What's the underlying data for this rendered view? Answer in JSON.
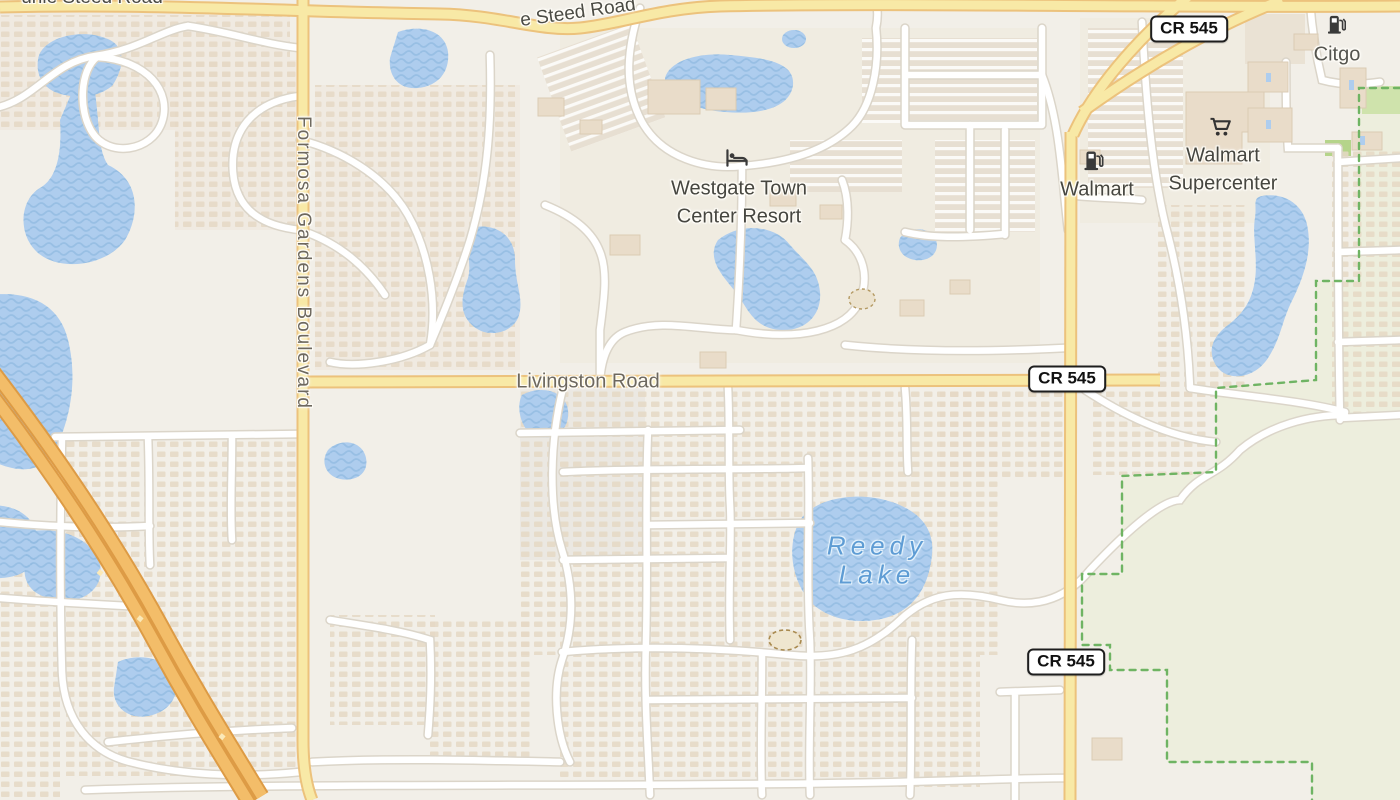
{
  "map": {
    "kind": "street-map",
    "road_labels": {
      "funie_steed_road_left": "unie Steed Road",
      "steed_road_top": "e Steed Road",
      "formosa_gardens_blvd": "Formosa Gardens Boulevard",
      "livingston_road": "Livingston Road"
    },
    "route_shields": {
      "label": "CR 545",
      "count": 3
    },
    "pois": {
      "westgate": {
        "line1": "Westgate Town",
        "line2": "Center Resort",
        "icon": "bed-lodging-icon"
      },
      "walmart_fuel": {
        "label": "Walmart",
        "icon": "fuel-pump-icon"
      },
      "walmart_supercenter": {
        "line1": "Walmart",
        "line2": "Supercenter",
        "icon": "shopping-cart-icon"
      },
      "citgo": {
        "label": "Citgo",
        "icon": "fuel-pump-icon"
      }
    },
    "water_labels": {
      "reedy_lake_line1": "Reedy",
      "reedy_lake_line2": "Lake"
    },
    "colors": {
      "background": "#f2efe8",
      "water": "#aecdee",
      "water_wave": "#92bbe1",
      "water_label": "#5e9cd4",
      "highway_fill": "#f3bd69",
      "highway_casing": "#dd9b45",
      "secondary_road_fill": "#f8e9a6",
      "secondary_road_casing": "#ecc27c",
      "minor_road_fill": "#ffffff",
      "minor_road_casing": "#dbd5c9",
      "green_area": "#edeedd",
      "green_boundary": "#6fb463",
      "building": "#e9dcc9",
      "poi_text": "#464640",
      "road_text": "#6d685e"
    }
  }
}
